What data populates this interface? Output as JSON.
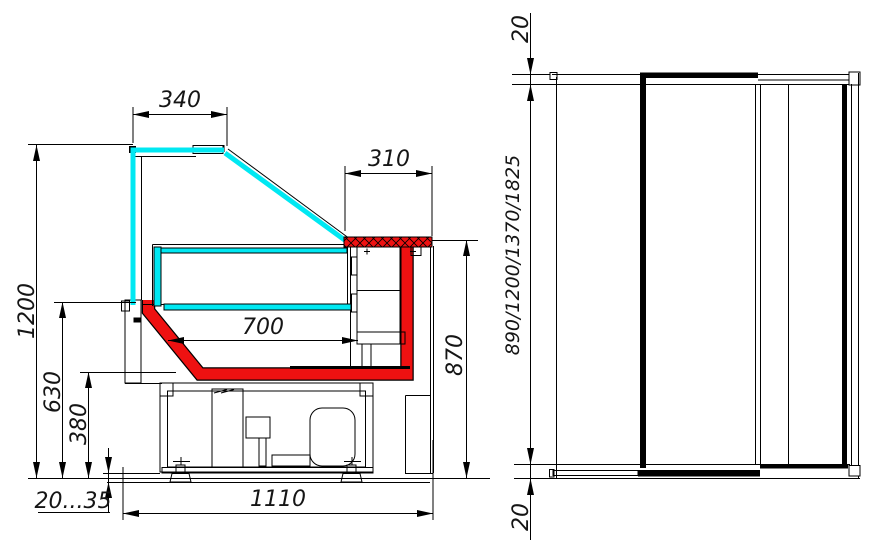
{
  "title": "Refrigerated display counter technical drawing",
  "colors": {
    "line": "#151515",
    "glass": "#00e8f2",
    "accent": "#ee1111"
  },
  "section_view": {
    "name": "cross-section-view",
    "dims": {
      "canopy_width": "340",
      "counter_shelf_depth": "310",
      "display_depth": "700",
      "overall_height": "1200",
      "front_panel_height": "630",
      "base_height": "380",
      "worktop_height": "870",
      "foot_adjust_range": "20...35",
      "overall_depth": "1110"
    }
  },
  "front_view": {
    "name": "front-view",
    "dims": {
      "top_offset": "20",
      "length_options": "890/1200/1370/1825",
      "bottom_offset": "20"
    }
  }
}
